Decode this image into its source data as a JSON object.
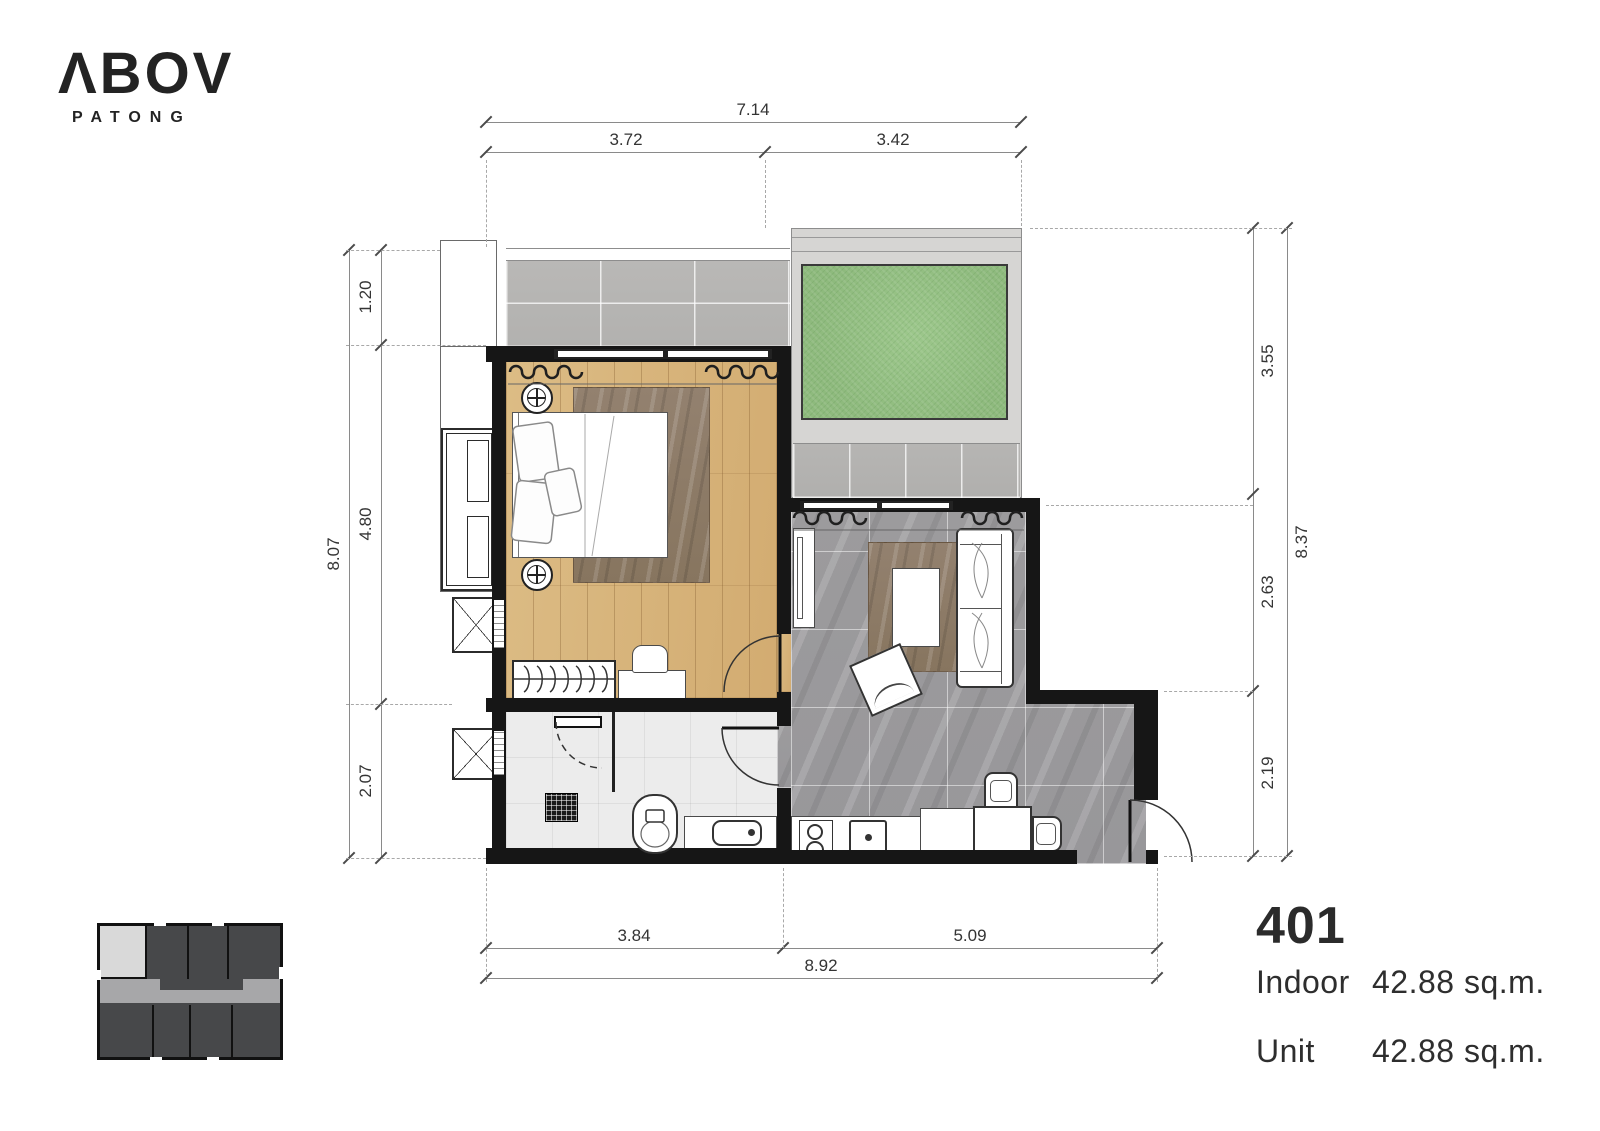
{
  "logo": {
    "brand": "ΛBOV",
    "subtitle": "PATONG"
  },
  "unit": {
    "number": "401",
    "rows": [
      {
        "label": "Indoor",
        "value": "42.88 sq.m."
      },
      {
        "label": "Unit",
        "value": "42.88 sq.m."
      }
    ]
  },
  "dims": {
    "top": {
      "overall": "7.14",
      "seg1": "3.72",
      "seg2": "3.42"
    },
    "bottom": {
      "overall": "8.92",
      "seg1": "3.84",
      "seg2": "5.09"
    },
    "left": {
      "overall": "8.07",
      "seg1": "1.20",
      "seg2": "4.80",
      "seg3": "2.07"
    },
    "right": {
      "overall": "8.37",
      "seg1": "3.55",
      "seg2": "2.63",
      "seg3": "2.19"
    }
  },
  "colors": {
    "wall": "#161616",
    "wood_floor": "#d7b57e",
    "living_tile": "#9b9a9d",
    "balcony_tile": "#b7b6b4",
    "terrace_concrete": "#d6d5d3",
    "grass": "#95c184",
    "bath_floor": "#ececec",
    "rug": "#8d7a6a",
    "keyplan_unit_dark": "#47484a",
    "keyplan_corridor": "#a7a7a9",
    "keyplan_highlight": "#d9d9d9"
  },
  "icons": {
    "keyplan": "building-keyplan-icon",
    "ac_units": "air-conditioner-icon",
    "fixtures": [
      "bed",
      "wardrobe",
      "toilet",
      "sink",
      "shower",
      "sofa",
      "dining-table",
      "cooktop",
      "kitchen-sink"
    ]
  }
}
